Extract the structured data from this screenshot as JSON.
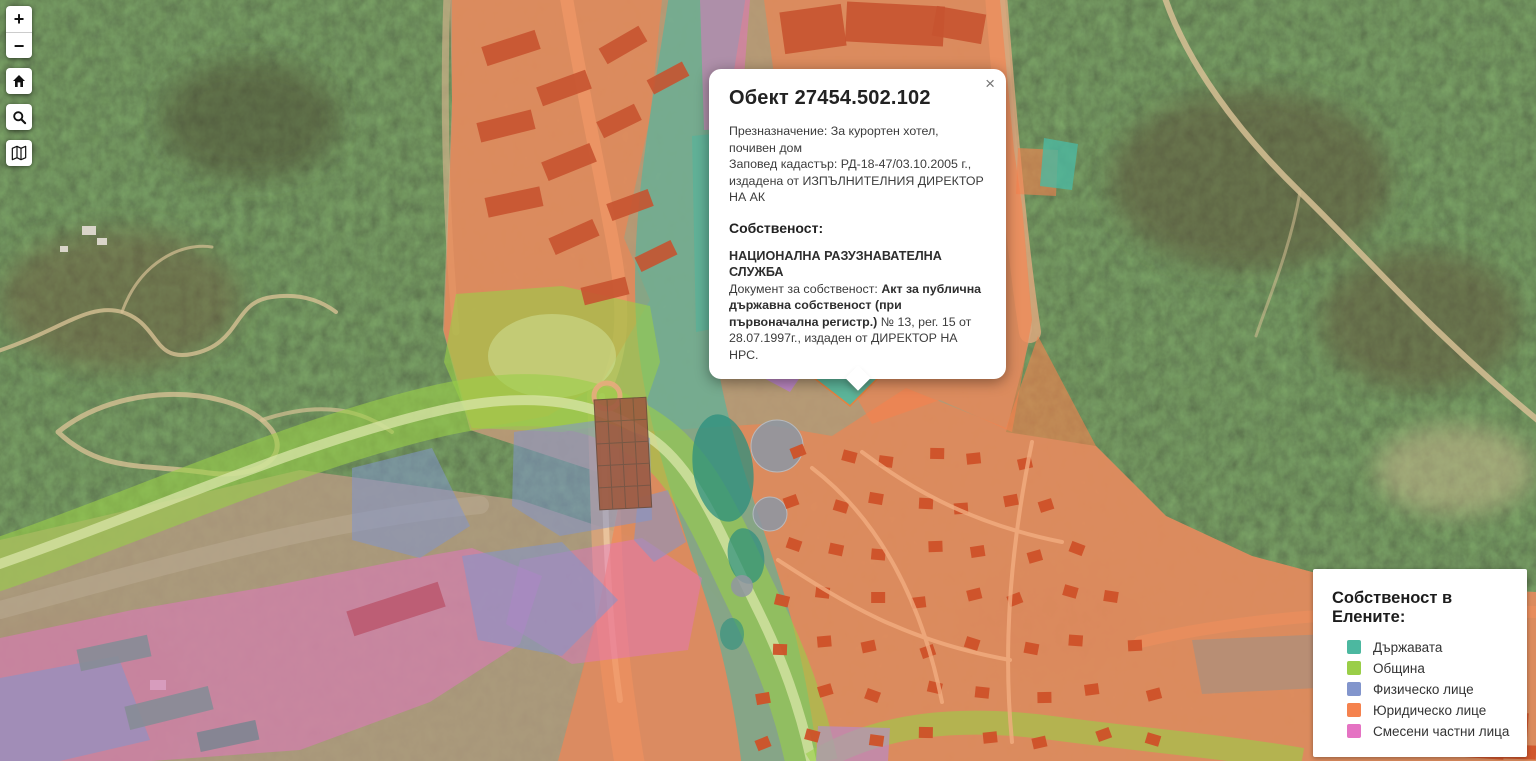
{
  "map": {
    "popup": {
      "title": "Обект 27454.502.102",
      "close": "×",
      "purpose": "Презназначение: За курортен хотел, почивен дом",
      "order": "Заповед кадастър: РД-18-47/03.10.2005 г., издадена от ИЗПЪЛНИТЕЛНИЯ ДИРЕКТОР НА АК",
      "ownership_heading": "Собственост:",
      "owner": "НАЦИОНАЛНА РАЗУЗНАВАТЕЛНА СЛУЖБА",
      "document_prefix": "Документ за собственост: ",
      "document_bold": "Акт за публична държавна собственост (при първоначална регистр.)",
      "document_suffix": " № 13, рег. 15 от 28.07.1997г., издаден от ДИРЕКТОР НА НРС."
    },
    "controls": {
      "zoom_in": "+",
      "zoom_out": "−"
    },
    "legend": {
      "title": "Собственост в Елените:",
      "items": [
        {
          "label": "Държавата",
          "color": "#4cb8a0"
        },
        {
          "label": "Община",
          "color": "#9ace48"
        },
        {
          "label": "Физическо лице",
          "color": "#8295cc"
        },
        {
          "label": "Юридическо лице",
          "color": "#f5824e"
        },
        {
          "label": "Смесени частни лица",
          "color": "#e573c3"
        }
      ]
    }
  }
}
